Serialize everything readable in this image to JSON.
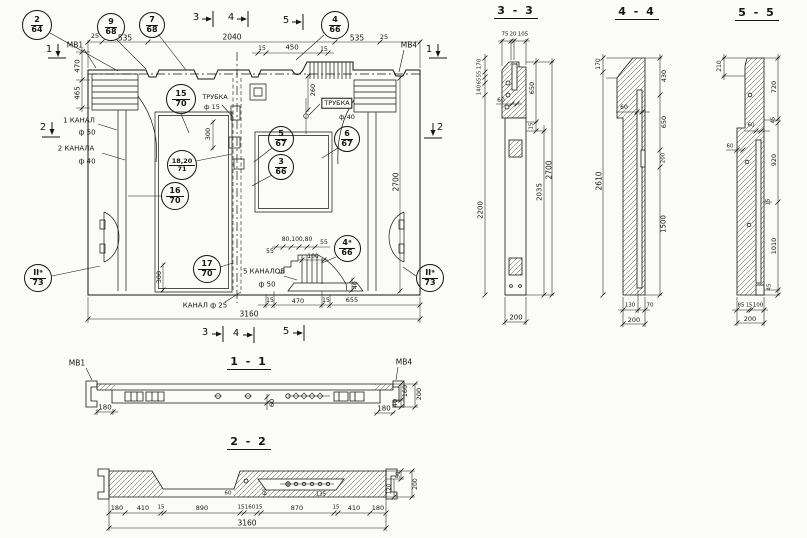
{
  "meta": {
    "ink": "#161616",
    "paper": "#fbfbf8"
  },
  "titles": {
    "s11": "1 - 1",
    "s22": "2 - 2",
    "s33": "3 - 3",
    "s44": "4 - 4",
    "s55": "5 - 5"
  },
  "callouts": [
    {
      "t": "2",
      "b": "64",
      "x": 37,
      "y": 25,
      "d": 30,
      "n": "callout-2-64"
    },
    {
      "t": "9",
      "b": "68",
      "x": 111,
      "y": 27,
      "d": 28,
      "n": "callout-9-68"
    },
    {
      "t": "7",
      "b": "68",
      "x": 152,
      "y": 25,
      "d": 26,
      "n": "callout-7-68"
    },
    {
      "t": "4",
      "b": "66",
      "x": 335,
      "y": 25,
      "d": 28,
      "n": "callout-4-66"
    },
    {
      "t": "15",
      "b": "70",
      "x": 181,
      "y": 99,
      "d": 30,
      "n": "callout-15-70"
    },
    {
      "t": "18,20",
      "b": "71",
      "x": 182,
      "y": 165,
      "d": 30,
      "fs": 6.5,
      "n": "callout-18-20-71"
    },
    {
      "t": "16",
      "b": "70",
      "x": 175,
      "y": 196,
      "d": 28,
      "n": "callout-16-70"
    },
    {
      "t": "17",
      "b": "70",
      "x": 207,
      "y": 269,
      "d": 28,
      "n": "callout-17-70"
    },
    {
      "t": "5",
      "b": "67",
      "x": 281,
      "y": 139,
      "d": 26,
      "n": "callout-5-67"
    },
    {
      "t": "3",
      "b": "66",
      "x": 281,
      "y": 167,
      "d": 26,
      "n": "callout-3-66"
    },
    {
      "t": "6",
      "b": "67",
      "x": 347,
      "y": 139,
      "d": 26,
      "n": "callout-6-67"
    },
    {
      "t": "4ᵃ",
      "b": "66",
      "x": 347,
      "y": 248,
      "d": 27,
      "n": "callout-4a-66"
    },
    {
      "t": "IIᵃ",
      "b": "73",
      "x": 38,
      "y": 278,
      "d": 28,
      "n": "callout-2a-73-left"
    },
    {
      "t": "IIᵃ",
      "b": "73",
      "x": 430,
      "y": 278,
      "d": 28,
      "n": "callout-2a-73-right"
    }
  ],
  "labels": [
    {
      "t": "МВ1",
      "x": 75,
      "y": 45,
      "n": "label-mv1"
    },
    {
      "t": "МВ4",
      "x": 409,
      "y": 45,
      "n": "label-mv4"
    },
    {
      "t": "25",
      "x": 95,
      "y": 36,
      "fs": 6.5
    },
    {
      "t": "535",
      "x": 125,
      "y": 38
    },
    {
      "t": "2040",
      "x": 232,
      "y": 37
    },
    {
      "t": "535",
      "x": 357,
      "y": 38
    },
    {
      "t": "25",
      "x": 384,
      "y": 37,
      "fs": 6.5
    },
    {
      "t": "15",
      "x": 262,
      "y": 49,
      "fs": 6
    },
    {
      "t": "450",
      "x": 292,
      "y": 48,
      "fs": 7
    },
    {
      "t": "15",
      "x": 324,
      "y": 50,
      "fs": 6
    },
    {
      "t": "470",
      "x": 78,
      "y": 66,
      "r": 1,
      "fs": 7
    },
    {
      "t": "465",
      "x": 78,
      "y": 93,
      "r": 1,
      "fs": 7
    },
    {
      "t": "1 КАНАЛ",
      "x": 79,
      "y": 121,
      "fs": 7,
      "n": "label-canal-1"
    },
    {
      "t": "ф 50",
      "x": 87,
      "y": 133,
      "fs": 7
    },
    {
      "t": "2 КАНАЛА",
      "x": 76,
      "y": 149,
      "fs": 7,
      "n": "label-canal-2"
    },
    {
      "t": "ф 40",
      "x": 87,
      "y": 162,
      "fs": 7
    },
    {
      "t": "ТРУБКА",
      "x": 215,
      "y": 97,
      "fs": 6.5,
      "n": "label-tube-15"
    },
    {
      "t": "ф 15",
      "x": 212,
      "y": 107,
      "fs": 6.5
    },
    {
      "t": "300",
      "x": 208,
      "y": 134,
      "r": 1,
      "fs": 6.5
    },
    {
      "t": "260",
      "x": 313,
      "y": 90,
      "r": 1,
      "fs": 6.5
    },
    {
      "t": "ТРУБКА",
      "x": 337,
      "y": 103,
      "fs": 6.5,
      "box": 1,
      "n": "label-tube-40"
    },
    {
      "t": "ф 40",
      "x": 347,
      "y": 117,
      "fs": 6.5
    },
    {
      "t": "2700",
      "x": 396,
      "y": 182,
      "r": 1
    },
    {
      "t": "55",
      "x": 270,
      "y": 252,
      "fs": 6
    },
    {
      "t": "80,100,80",
      "x": 297,
      "y": 240,
      "fs": 6
    },
    {
      "t": "55",
      "x": 324,
      "y": 243,
      "fs": 6
    },
    {
      "t": "100",
      "x": 313,
      "y": 257,
      "fs": 6
    },
    {
      "t": "40",
      "x": 356,
      "y": 285,
      "r": 1,
      "fs": 6
    },
    {
      "t": "5 КАНАЛОВ",
      "x": 264,
      "y": 272,
      "fs": 7,
      "n": "label-5-canals"
    },
    {
      "t": "ф 50",
      "x": 267,
      "y": 285,
      "fs": 7
    },
    {
      "t": "КАНАЛ ф 25",
      "x": 205,
      "y": 306,
      "fs": 7,
      "n": "label-canal-25"
    },
    {
      "t": "300",
      "x": 159,
      "y": 277,
      "r": 1,
      "fs": 6.5
    },
    {
      "t": "15",
      "x": 270,
      "y": 301,
      "fs": 6
    },
    {
      "t": "470",
      "x": 298,
      "y": 301,
      "fs": 6.5
    },
    {
      "t": "15",
      "x": 326,
      "y": 301,
      "fs": 6
    },
    {
      "t": "655",
      "x": 352,
      "y": 300,
      "fs": 6.5
    },
    {
      "t": "3160",
      "x": 249,
      "y": 314,
      "n": "dim-panel-width"
    },
    {
      "t": "3",
      "x": 196,
      "y": 18,
      "fs": 10,
      "n": "section-mark-3-top"
    },
    {
      "t": "4",
      "x": 231,
      "y": 18,
      "fs": 10,
      "n": "section-mark-4-top"
    },
    {
      "t": "5",
      "x": 286,
      "y": 21,
      "fs": 10,
      "n": "section-mark-5-top"
    },
    {
      "t": "1",
      "x": 49,
      "y": 50,
      "fs": 10,
      "n": "section-mark-1-left"
    },
    {
      "t": "1",
      "x": 429,
      "y": 50,
      "fs": 10,
      "n": "section-mark-1-right"
    },
    {
      "t": "2",
      "x": 43,
      "y": 128,
      "fs": 10,
      "n": "section-mark-2-left"
    },
    {
      "t": "2",
      "x": 440,
      "y": 128,
      "fs": 10,
      "n": "section-mark-2-right"
    },
    {
      "t": "3",
      "x": 205,
      "y": 333,
      "fs": 10,
      "n": "section-mark-3-bottom"
    },
    {
      "t": "4",
      "x": 236,
      "y": 334,
      "fs": 10,
      "n": "section-mark-4-bottom"
    },
    {
      "t": "5",
      "x": 286,
      "y": 332,
      "fs": 10,
      "n": "section-mark-5-bottom"
    },
    {
      "t": "МВ1",
      "x": 77,
      "y": 363,
      "fs": 7.5,
      "n": "label-s11-mv1"
    },
    {
      "t": "МВ4",
      "x": 404,
      "y": 362,
      "fs": 7.5,
      "n": "label-s11-mv4"
    },
    {
      "t": "180",
      "x": 105,
      "y": 408,
      "fs": 7
    },
    {
      "t": "180",
      "x": 384,
      "y": 409,
      "fs": 7
    },
    {
      "t": "60",
      "x": 272,
      "y": 403,
      "r": 1,
      "fs": 6.5
    },
    {
      "t": "160",
      "x": 405,
      "y": 391,
      "r": 1,
      "fs": 6.5
    },
    {
      "t": "40",
      "x": 395,
      "y": 403,
      "r": 1,
      "fs": 6.5
    },
    {
      "t": "200",
      "x": 419,
      "y": 394,
      "r": 1,
      "fs": 6.5
    },
    {
      "t": "180",
      "x": 117,
      "y": 508,
      "fs": 6.5
    },
    {
      "t": "410",
      "x": 143,
      "y": 508,
      "fs": 6.5
    },
    {
      "t": "15",
      "x": 161,
      "y": 508,
      "fs": 5.5
    },
    {
      "t": "890",
      "x": 202,
      "y": 508,
      "fs": 6.5
    },
    {
      "t": "15",
      "x": 241,
      "y": 508,
      "fs": 5.5
    },
    {
      "t": "160",
      "x": 250,
      "y": 508,
      "fs": 5.5
    },
    {
      "t": "15",
      "x": 259,
      "y": 508,
      "fs": 5.5
    },
    {
      "t": "870",
      "x": 297,
      "y": 508,
      "fs": 6.5
    },
    {
      "t": "15",
      "x": 336,
      "y": 508,
      "fs": 5.5
    },
    {
      "t": "410",
      "x": 354,
      "y": 508,
      "fs": 6.5
    },
    {
      "t": "180",
      "x": 378,
      "y": 508,
      "fs": 6.5
    },
    {
      "t": "60",
      "x": 228,
      "y": 494,
      "fs": 5.5
    },
    {
      "t": "60",
      "x": 266,
      "y": 492,
      "r": 1,
      "fs": 5.5
    },
    {
      "t": "135",
      "x": 321,
      "y": 495,
      "fs": 5.5
    },
    {
      "t": "3160",
      "x": 247,
      "y": 523,
      "n": "dim-s22-width"
    },
    {
      "t": "50",
      "x": 399,
      "y": 475,
      "r": 1,
      "fs": 5.5
    },
    {
      "t": "120",
      "x": 390,
      "y": 489,
      "r": 1,
      "fs": 5.5
    },
    {
      "t": "200",
      "x": 416,
      "y": 484,
      "r": 1,
      "fs": 6
    },
    {
      "t": "75",
      "x": 505,
      "y": 35,
      "fs": 5.5
    },
    {
      "t": "20",
      "x": 513,
      "y": 35,
      "fs": 5.5
    },
    {
      "t": "105",
      "x": 523,
      "y": 35,
      "fs": 5.5
    },
    {
      "t": "170",
      "x": 480,
      "y": 64,
      "r": 1,
      "fs": 5.5
    },
    {
      "t": "55",
      "x": 480,
      "y": 74,
      "r": 1,
      "fs": 5
    },
    {
      "t": "65",
      "x": 480,
      "y": 81,
      "r": 1,
      "fs": 5
    },
    {
      "t": "140",
      "x": 480,
      "y": 90,
      "r": 1,
      "fs": 5.5
    },
    {
      "t": "60",
      "x": 501,
      "y": 101,
      "fs": 6
    },
    {
      "t": "650",
      "x": 532,
      "y": 88,
      "r": 1,
      "fs": 6.5
    },
    {
      "t": "15",
      "x": 532,
      "y": 126,
      "r": 1,
      "fs": 5.5
    },
    {
      "t": "2200",
      "x": 481,
      "y": 210,
      "r": 1,
      "fs": 7
    },
    {
      "t": "2035",
      "x": 540,
      "y": 192,
      "r": 1,
      "fs": 7
    },
    {
      "t": "2700",
      "x": 549,
      "y": 170,
      "r": 1,
      "fs": 7.5
    },
    {
      "t": "200",
      "x": 516,
      "y": 318,
      "fs": 7
    },
    {
      "t": "170",
      "x": 599,
      "y": 64,
      "r": 1,
      "fs": 6
    },
    {
      "t": "2610",
      "x": 599,
      "y": 181,
      "r": 1,
      "fs": 7.5
    },
    {
      "t": "60",
      "x": 624,
      "y": 108,
      "fs": 6
    },
    {
      "t": "430",
      "x": 664,
      "y": 76,
      "r": 1,
      "fs": 6.5
    },
    {
      "t": "650",
      "x": 664,
      "y": 122,
      "r": 1,
      "fs": 6.5
    },
    {
      "t": "200",
      "x": 664,
      "y": 158,
      "r": 1,
      "fs": 5.5
    },
    {
      "t": "1500",
      "x": 664,
      "y": 224,
      "r": 1,
      "fs": 7
    },
    {
      "t": "130",
      "x": 630,
      "y": 306,
      "fs": 5.5
    },
    {
      "t": "70",
      "x": 650,
      "y": 306,
      "fs": 5.5
    },
    {
      "t": "200",
      "x": 634,
      "y": 320,
      "fs": 6.5
    },
    {
      "t": "210",
      "x": 720,
      "y": 66,
      "r": 1,
      "fs": 6
    },
    {
      "t": "720",
      "x": 774,
      "y": 87,
      "r": 1,
      "fs": 6.5
    },
    {
      "t": "45",
      "x": 774,
      "y": 120,
      "r": 1,
      "fs": 5.5
    },
    {
      "t": "60",
      "x": 751,
      "y": 126,
      "fs": 5.5
    },
    {
      "t": "60",
      "x": 730,
      "y": 147,
      "fs": 5.5
    },
    {
      "t": "920",
      "x": 774,
      "y": 160,
      "r": 1,
      "fs": 6.5
    },
    {
      "t": "15",
      "x": 769,
      "y": 202,
      "r": 1,
      "fs": 5.5
    },
    {
      "t": "1010",
      "x": 774,
      "y": 246,
      "r": 1,
      "fs": 6.5
    },
    {
      "t": "45",
      "x": 770,
      "y": 287,
      "r": 1,
      "fs": 5.5
    },
    {
      "t": "85",
      "x": 741,
      "y": 306,
      "fs": 5.5
    },
    {
      "t": "15",
      "x": 749,
      "y": 306,
      "fs": 5
    },
    {
      "t": "100",
      "x": 758,
      "y": 306,
      "fs": 5.5
    },
    {
      "t": "200",
      "x": 750,
      "y": 319,
      "fs": 6.5
    }
  ]
}
